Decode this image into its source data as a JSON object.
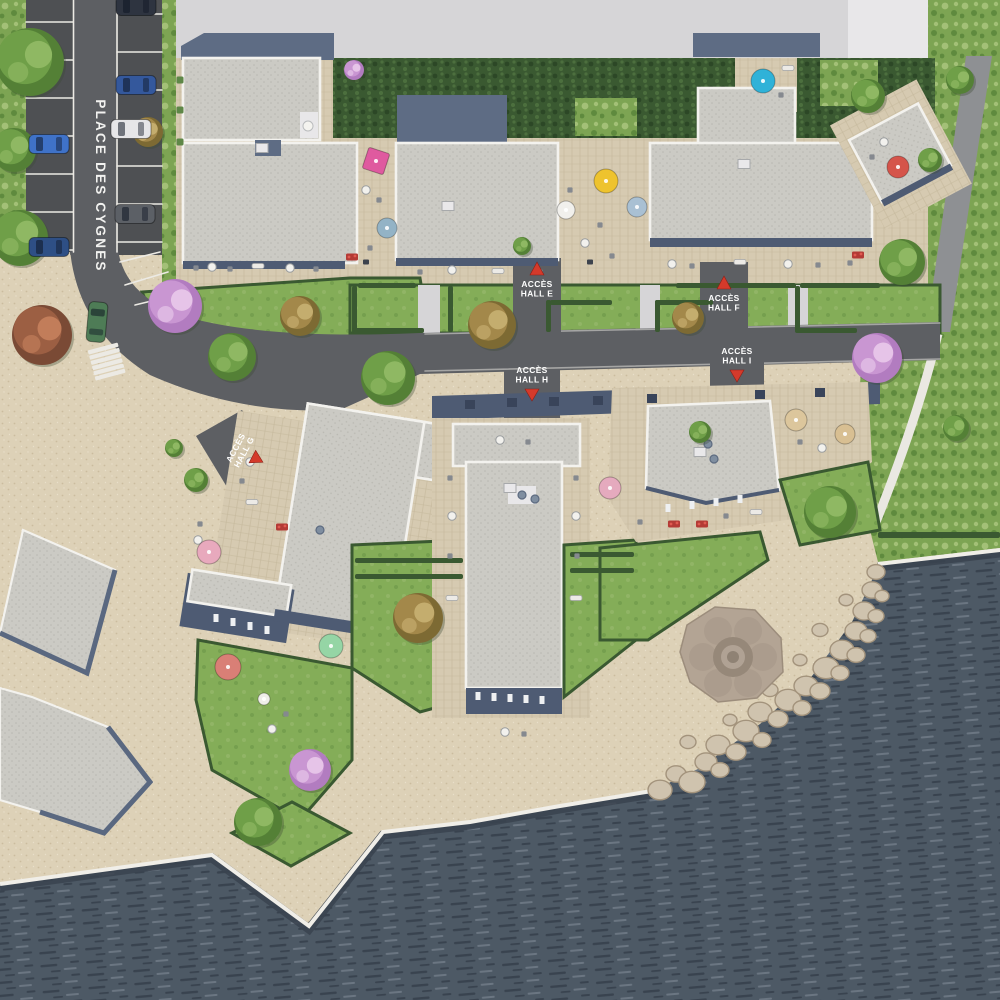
{
  "labels": {
    "road_name": "PLACE DES CYGNES",
    "halls": [
      {
        "line1": "ACCÈS",
        "line2": "HALL E",
        "x": 537,
        "y": 289,
        "dir": "up",
        "rot": 0
      },
      {
        "line1": "ACCÈS",
        "line2": "HALL F",
        "x": 724,
        "y": 303,
        "dir": "up",
        "rot": 0
      },
      {
        "line1": "ACCÈS",
        "line2": "HALL G",
        "x": 240,
        "y": 450,
        "dir": "down",
        "rot": -62
      },
      {
        "line1": "ACCÈS",
        "line2": "HALL H",
        "x": 532,
        "y": 375,
        "dir": "down",
        "rot": 0
      },
      {
        "line1": "ACCÈS",
        "line2": "HALL I",
        "x": 737,
        "y": 356,
        "dir": "down",
        "rot": 0
      }
    ]
  },
  "palette": {
    "water": "#4d5965",
    "water_dark": "#39434f",
    "water_light": "#6b7682",
    "sand": "#ddd1b7",
    "sand_dot": "#cbbc9e",
    "sand_light": "#e9dfca",
    "grass": "#7da453",
    "grass_light": "#a3c077",
    "grass_dark": "#5f8a3e",
    "lawn": "#84ad58",
    "hedge": "#3a5931",
    "hedge_dark": "#2c4726",
    "road": "#5d5f63",
    "parking": "#4e5053",
    "path_gray": "#8e9093",
    "line_white": "#eceae4",
    "roof": "#cbcac4",
    "roof_dot": "#b9b8b1",
    "parapet": "#f3f2ee",
    "roof_blue": "#5e6c84",
    "fascia": "#4e5b73",
    "terrace": "#d6cab1",
    "terrace_line": "#c5b89c",
    "concrete": "#d6d5d7",
    "concrete_light": "#e8e7e9",
    "quay_white": "#f0eee8",
    "rock": "#cfc3ae",
    "rock_edge": "#a3937c",
    "label_red": "#d43a2b",
    "label_white": "#ffffff",
    "tree_green": "#6f9f48",
    "tree_green_dark": "#548036",
    "tree_green_light": "#8fb863",
    "tree_pink": "#c996d2",
    "tree_pink_dark": "#b27cc0",
    "tree_pink_light": "#e6c4e8",
    "tree_autumn": "#a3884a",
    "tree_autumn_dark": "#7d6a33",
    "tree_autumn_light": "#c4ad6e",
    "bush_red": "#9c5f43",
    "bush_red_dark": "#7a4a35",
    "bush_red_light": "#c27d5a"
  },
  "objects": {
    "trees": [
      {
        "x": 30,
        "y": 62,
        "r": 34,
        "t": "green"
      },
      {
        "x": 14,
        "y": 150,
        "r": 22,
        "t": "green"
      },
      {
        "x": 20,
        "y": 238,
        "r": 28,
        "t": "green"
      },
      {
        "x": 42,
        "y": 335,
        "r": 30,
        "t": "redbush"
      },
      {
        "x": 148,
        "y": 132,
        "r": 15,
        "t": "autumn"
      },
      {
        "x": 175,
        "y": 306,
        "r": 27,
        "t": "pink"
      },
      {
        "x": 232,
        "y": 357,
        "r": 24,
        "t": "green"
      },
      {
        "x": 300,
        "y": 316,
        "r": 20,
        "t": "autumn"
      },
      {
        "x": 388,
        "y": 378,
        "r": 27,
        "t": "green"
      },
      {
        "x": 492,
        "y": 325,
        "r": 24,
        "t": "autumn"
      },
      {
        "x": 688,
        "y": 318,
        "r": 16,
        "t": "autumn"
      },
      {
        "x": 877,
        "y": 358,
        "r": 25,
        "t": "pink"
      },
      {
        "x": 902,
        "y": 262,
        "r": 23,
        "t": "green"
      },
      {
        "x": 868,
        "y": 96,
        "r": 17,
        "t": "green"
      },
      {
        "x": 830,
        "y": 512,
        "r": 26,
        "t": "green"
      },
      {
        "x": 956,
        "y": 428,
        "r": 13,
        "t": "green"
      },
      {
        "x": 418,
        "y": 618,
        "r": 25,
        "t": "autumn"
      },
      {
        "x": 310,
        "y": 770,
        "r": 21,
        "t": "pink"
      },
      {
        "x": 258,
        "y": 822,
        "r": 24,
        "t": "green"
      },
      {
        "x": 196,
        "y": 480,
        "r": 12,
        "t": "green"
      },
      {
        "x": 174,
        "y": 448,
        "r": 9,
        "t": "green"
      },
      {
        "x": 354,
        "y": 70,
        "r": 10,
        "t": "pink"
      },
      {
        "x": 522,
        "y": 246,
        "r": 9,
        "t": "green"
      },
      {
        "x": 700,
        "y": 432,
        "r": 11,
        "t": "green"
      },
      {
        "x": 930,
        "y": 160,
        "r": 12,
        "t": "green"
      },
      {
        "x": 960,
        "y": 80,
        "r": 14,
        "t": "green"
      }
    ],
    "parasols": [
      {
        "x": 376,
        "y": 161,
        "c": "#df5a9f",
        "r": 11,
        "shape": "square",
        "rot": 18
      },
      {
        "x": 387,
        "y": 228,
        "c": "#93b3c6",
        "r": 10
      },
      {
        "x": 606,
        "y": 181,
        "c": "#eec32e",
        "r": 12
      },
      {
        "x": 637,
        "y": 207,
        "c": "#a9c0d3",
        "r": 10
      },
      {
        "x": 763,
        "y": 81,
        "c": "#2fb2d8",
        "r": 12
      },
      {
        "x": 898,
        "y": 167,
        "c": "#d5544a",
        "r": 11
      },
      {
        "x": 566,
        "y": 210,
        "c": "#f1f0ec",
        "r": 9
      },
      {
        "x": 209,
        "y": 552,
        "c": "#e8a9bd",
        "r": 12
      },
      {
        "x": 228,
        "y": 667,
        "c": "#d97f76",
        "r": 13
      },
      {
        "x": 331,
        "y": 646,
        "c": "#95d5a5",
        "r": 12
      },
      {
        "x": 610,
        "y": 488,
        "c": "#e5aabe",
        "r": 11
      },
      {
        "x": 796,
        "y": 420,
        "c": "#dcc69c",
        "r": 11
      },
      {
        "x": 845,
        "y": 434,
        "c": "#d8bf92",
        "r": 10
      },
      {
        "x": 264,
        "y": 699,
        "c": "#efeeea",
        "r": 6
      }
    ],
    "cars": [
      {
        "x": 49,
        "y": 144,
        "c": "#3f72c8"
      },
      {
        "x": 49,
        "y": 247,
        "c": "#2e4f85"
      },
      {
        "x": 136,
        "y": 6,
        "c": "#2e3440"
      },
      {
        "x": 136,
        "y": 85,
        "c": "#34589c"
      },
      {
        "x": 131,
        "y": 129,
        "c": "#e6e6e8"
      },
      {
        "x": 135,
        "y": 214,
        "c": "#5c6066"
      },
      {
        "x": 97,
        "y": 322,
        "c": "#4e7c56",
        "rot": 95
      }
    ],
    "parking_lines": {
      "left_lane": {
        "x1": 26,
        "x2": 73,
        "ys": [
          22,
          60,
          98,
          136,
          174,
          212,
          250
        ]
      },
      "right_lane": {
        "x1": 117,
        "x2": 162,
        "ys": [
          14,
          52,
          90,
          128,
          166,
          204,
          242
        ]
      },
      "lane_dividers": [
        [
          73.5,
          0,
          73.5,
          252
        ],
        [
          117,
          0,
          117,
          252
        ]
      ],
      "curve_bays": [
        [
          120,
          262,
          160,
          252
        ],
        [
          125,
          285,
          168,
          272
        ],
        [
          135,
          305,
          172,
          296
        ]
      ]
    },
    "crosswalk": {
      "x": 91,
      "y": 346,
      "count": 6,
      "w": 31,
      "h": 4.2,
      "gap": 5.4,
      "rot": -15
    },
    "hedge_strips": [
      [
        352,
        286,
        5,
        46
      ],
      [
        352,
        328,
        72,
        5
      ],
      [
        448,
        286,
        5,
        46
      ],
      [
        546,
        300,
        5,
        32
      ],
      [
        550,
        300,
        62,
        5
      ],
      [
        655,
        300,
        58,
        5
      ],
      [
        655,
        300,
        5,
        32
      ],
      [
        795,
        286,
        5,
        46
      ],
      [
        795,
        328,
        62,
        5
      ],
      [
        358,
        283,
        58,
        5
      ],
      [
        676,
        283,
        120,
        5
      ],
      [
        800,
        283,
        80,
        5
      ],
      [
        355,
        558,
        108,
        5
      ],
      [
        355,
        574,
        108,
        5
      ],
      [
        570,
        552,
        64,
        5
      ],
      [
        570,
        568,
        64,
        5
      ],
      [
        878,
        532,
        122,
        6
      ]
    ],
    "flowers": [
      {
        "x": 352,
        "y": 257
      },
      {
        "x": 858,
        "y": 255
      },
      {
        "x": 674,
        "y": 524
      },
      {
        "x": 702,
        "y": 524
      },
      {
        "x": 282,
        "y": 527
      }
    ],
    "furniture": [
      {
        "x": 196,
        "y": 268,
        "t": "c"
      },
      {
        "x": 212,
        "y": 267,
        "t": "t"
      },
      {
        "x": 230,
        "y": 269,
        "t": "c"
      },
      {
        "x": 258,
        "y": 266,
        "t": "l"
      },
      {
        "x": 290,
        "y": 268,
        "t": "t"
      },
      {
        "x": 316,
        "y": 269,
        "t": "c"
      },
      {
        "x": 180,
        "y": 80,
        "t": "p"
      },
      {
        "x": 180,
        "y": 110,
        "t": "p"
      },
      {
        "x": 180,
        "y": 142,
        "t": "p"
      },
      {
        "x": 308,
        "y": 126,
        "t": "w"
      },
      {
        "x": 366,
        "y": 190,
        "t": "t"
      },
      {
        "x": 379,
        "y": 200,
        "t": "c"
      },
      {
        "x": 370,
        "y": 248,
        "t": "c"
      },
      {
        "x": 366,
        "y": 262,
        "t": "g"
      },
      {
        "x": 420,
        "y": 272,
        "t": "c"
      },
      {
        "x": 452,
        "y": 270,
        "t": "t"
      },
      {
        "x": 498,
        "y": 271,
        "t": "l"
      },
      {
        "x": 540,
        "y": 272,
        "t": "c"
      },
      {
        "x": 585,
        "y": 243,
        "t": "t"
      },
      {
        "x": 600,
        "y": 225,
        "t": "c"
      },
      {
        "x": 612,
        "y": 256,
        "t": "c"
      },
      {
        "x": 590,
        "y": 262,
        "t": "g"
      },
      {
        "x": 570,
        "y": 190,
        "t": "c"
      },
      {
        "x": 672,
        "y": 264,
        "t": "t"
      },
      {
        "x": 692,
        "y": 266,
        "t": "c"
      },
      {
        "x": 740,
        "y": 262,
        "t": "l"
      },
      {
        "x": 788,
        "y": 264,
        "t": "t"
      },
      {
        "x": 818,
        "y": 265,
        "t": "c"
      },
      {
        "x": 850,
        "y": 263,
        "t": "c"
      },
      {
        "x": 788,
        "y": 68,
        "t": "l"
      },
      {
        "x": 781,
        "y": 95,
        "t": "c"
      },
      {
        "x": 884,
        "y": 142,
        "t": "t"
      },
      {
        "x": 872,
        "y": 157,
        "t": "c"
      },
      {
        "x": 262,
        "y": 148,
        "t": "ac"
      },
      {
        "x": 448,
        "y": 206,
        "t": "ac"
      },
      {
        "x": 744,
        "y": 164,
        "t": "ac"
      },
      {
        "x": 510,
        "y": 488,
        "t": "ac"
      },
      {
        "x": 700,
        "y": 452,
        "t": "ac"
      },
      {
        "x": 320,
        "y": 530,
        "t": "v"
      },
      {
        "x": 522,
        "y": 495,
        "t": "v"
      },
      {
        "x": 535,
        "y": 499,
        "t": "v"
      },
      {
        "x": 708,
        "y": 444,
        "t": "v"
      },
      {
        "x": 714,
        "y": 459,
        "t": "v"
      },
      {
        "x": 470,
        "y": 404,
        "t": "d"
      },
      {
        "x": 512,
        "y": 402,
        "t": "d"
      },
      {
        "x": 554,
        "y": 401,
        "t": "d"
      },
      {
        "x": 598,
        "y": 400,
        "t": "d"
      },
      {
        "x": 652,
        "y": 398,
        "t": "d"
      },
      {
        "x": 760,
        "y": 394,
        "t": "d"
      },
      {
        "x": 820,
        "y": 392,
        "t": "d"
      },
      {
        "x": 450,
        "y": 478,
        "t": "c"
      },
      {
        "x": 452,
        "y": 516,
        "t": "t"
      },
      {
        "x": 450,
        "y": 556,
        "t": "c"
      },
      {
        "x": 452,
        "y": 598,
        "t": "l"
      },
      {
        "x": 576,
        "y": 478,
        "t": "c"
      },
      {
        "x": 576,
        "y": 516,
        "t": "t"
      },
      {
        "x": 577,
        "y": 556,
        "t": "c"
      },
      {
        "x": 576,
        "y": 598,
        "t": "l"
      },
      {
        "x": 500,
        "y": 440,
        "t": "t"
      },
      {
        "x": 528,
        "y": 442,
        "t": "c"
      },
      {
        "x": 800,
        "y": 442,
        "t": "c"
      },
      {
        "x": 822,
        "y": 448,
        "t": "t"
      },
      {
        "x": 640,
        "y": 522,
        "t": "c"
      },
      {
        "x": 726,
        "y": 516,
        "t": "c"
      },
      {
        "x": 756,
        "y": 512,
        "t": "l"
      },
      {
        "x": 505,
        "y": 732,
        "t": "t"
      },
      {
        "x": 524,
        "y": 734,
        "t": "c"
      },
      {
        "x": 250,
        "y": 462,
        "t": "t"
      },
      {
        "x": 242,
        "y": 481,
        "t": "c"
      },
      {
        "x": 252,
        "y": 502,
        "t": "l"
      },
      {
        "x": 200,
        "y": 524,
        "t": "c"
      },
      {
        "x": 198,
        "y": 540,
        "t": "t"
      },
      {
        "x": 286,
        "y": 714,
        "t": "c"
      },
      {
        "x": 272,
        "y": 729,
        "t": "t"
      },
      {
        "x": 478,
        "y": 696,
        "t": "wt"
      },
      {
        "x": 494,
        "y": 697,
        "t": "wt"
      },
      {
        "x": 510,
        "y": 698,
        "t": "wt"
      },
      {
        "x": 526,
        "y": 699,
        "t": "wt"
      },
      {
        "x": 542,
        "y": 700,
        "t": "wt"
      },
      {
        "x": 216,
        "y": 618,
        "t": "wt"
      },
      {
        "x": 233,
        "y": 622,
        "t": "wt"
      },
      {
        "x": 250,
        "y": 626,
        "t": "wt"
      },
      {
        "x": 267,
        "y": 630,
        "t": "wt"
      },
      {
        "x": 668,
        "y": 508,
        "t": "wt"
      },
      {
        "x": 692,
        "y": 505,
        "t": "wt"
      },
      {
        "x": 716,
        "y": 502,
        "t": "wt"
      },
      {
        "x": 740,
        "y": 499,
        "t": "wt"
      }
    ],
    "boulders": [
      [
        660,
        790,
        12
      ],
      [
        676,
        774,
        10
      ],
      [
        692,
        782,
        13
      ],
      [
        706,
        762,
        11
      ],
      [
        720,
        770,
        9
      ],
      [
        718,
        745,
        12
      ],
      [
        736,
        752,
        10
      ],
      [
        746,
        731,
        13
      ],
      [
        762,
        740,
        9
      ],
      [
        760,
        712,
        12
      ],
      [
        778,
        719,
        10
      ],
      [
        788,
        700,
        13
      ],
      [
        802,
        708,
        9
      ],
      [
        806,
        686,
        12
      ],
      [
        820,
        691,
        10
      ],
      [
        826,
        668,
        13
      ],
      [
        840,
        673,
        9
      ],
      [
        842,
        650,
        12
      ],
      [
        856,
        655,
        9
      ],
      [
        856,
        631,
        11
      ],
      [
        868,
        636,
        8
      ],
      [
        864,
        611,
        11
      ],
      [
        876,
        616,
        8
      ],
      [
        872,
        590,
        10
      ],
      [
        882,
        596,
        7
      ],
      [
        876,
        572,
        9
      ],
      [
        688,
        742,
        8
      ],
      [
        730,
        720,
        7
      ],
      [
        770,
        690,
        8
      ],
      [
        800,
        660,
        7
      ],
      [
        820,
        630,
        8
      ],
      [
        846,
        600,
        7
      ]
    ]
  }
}
